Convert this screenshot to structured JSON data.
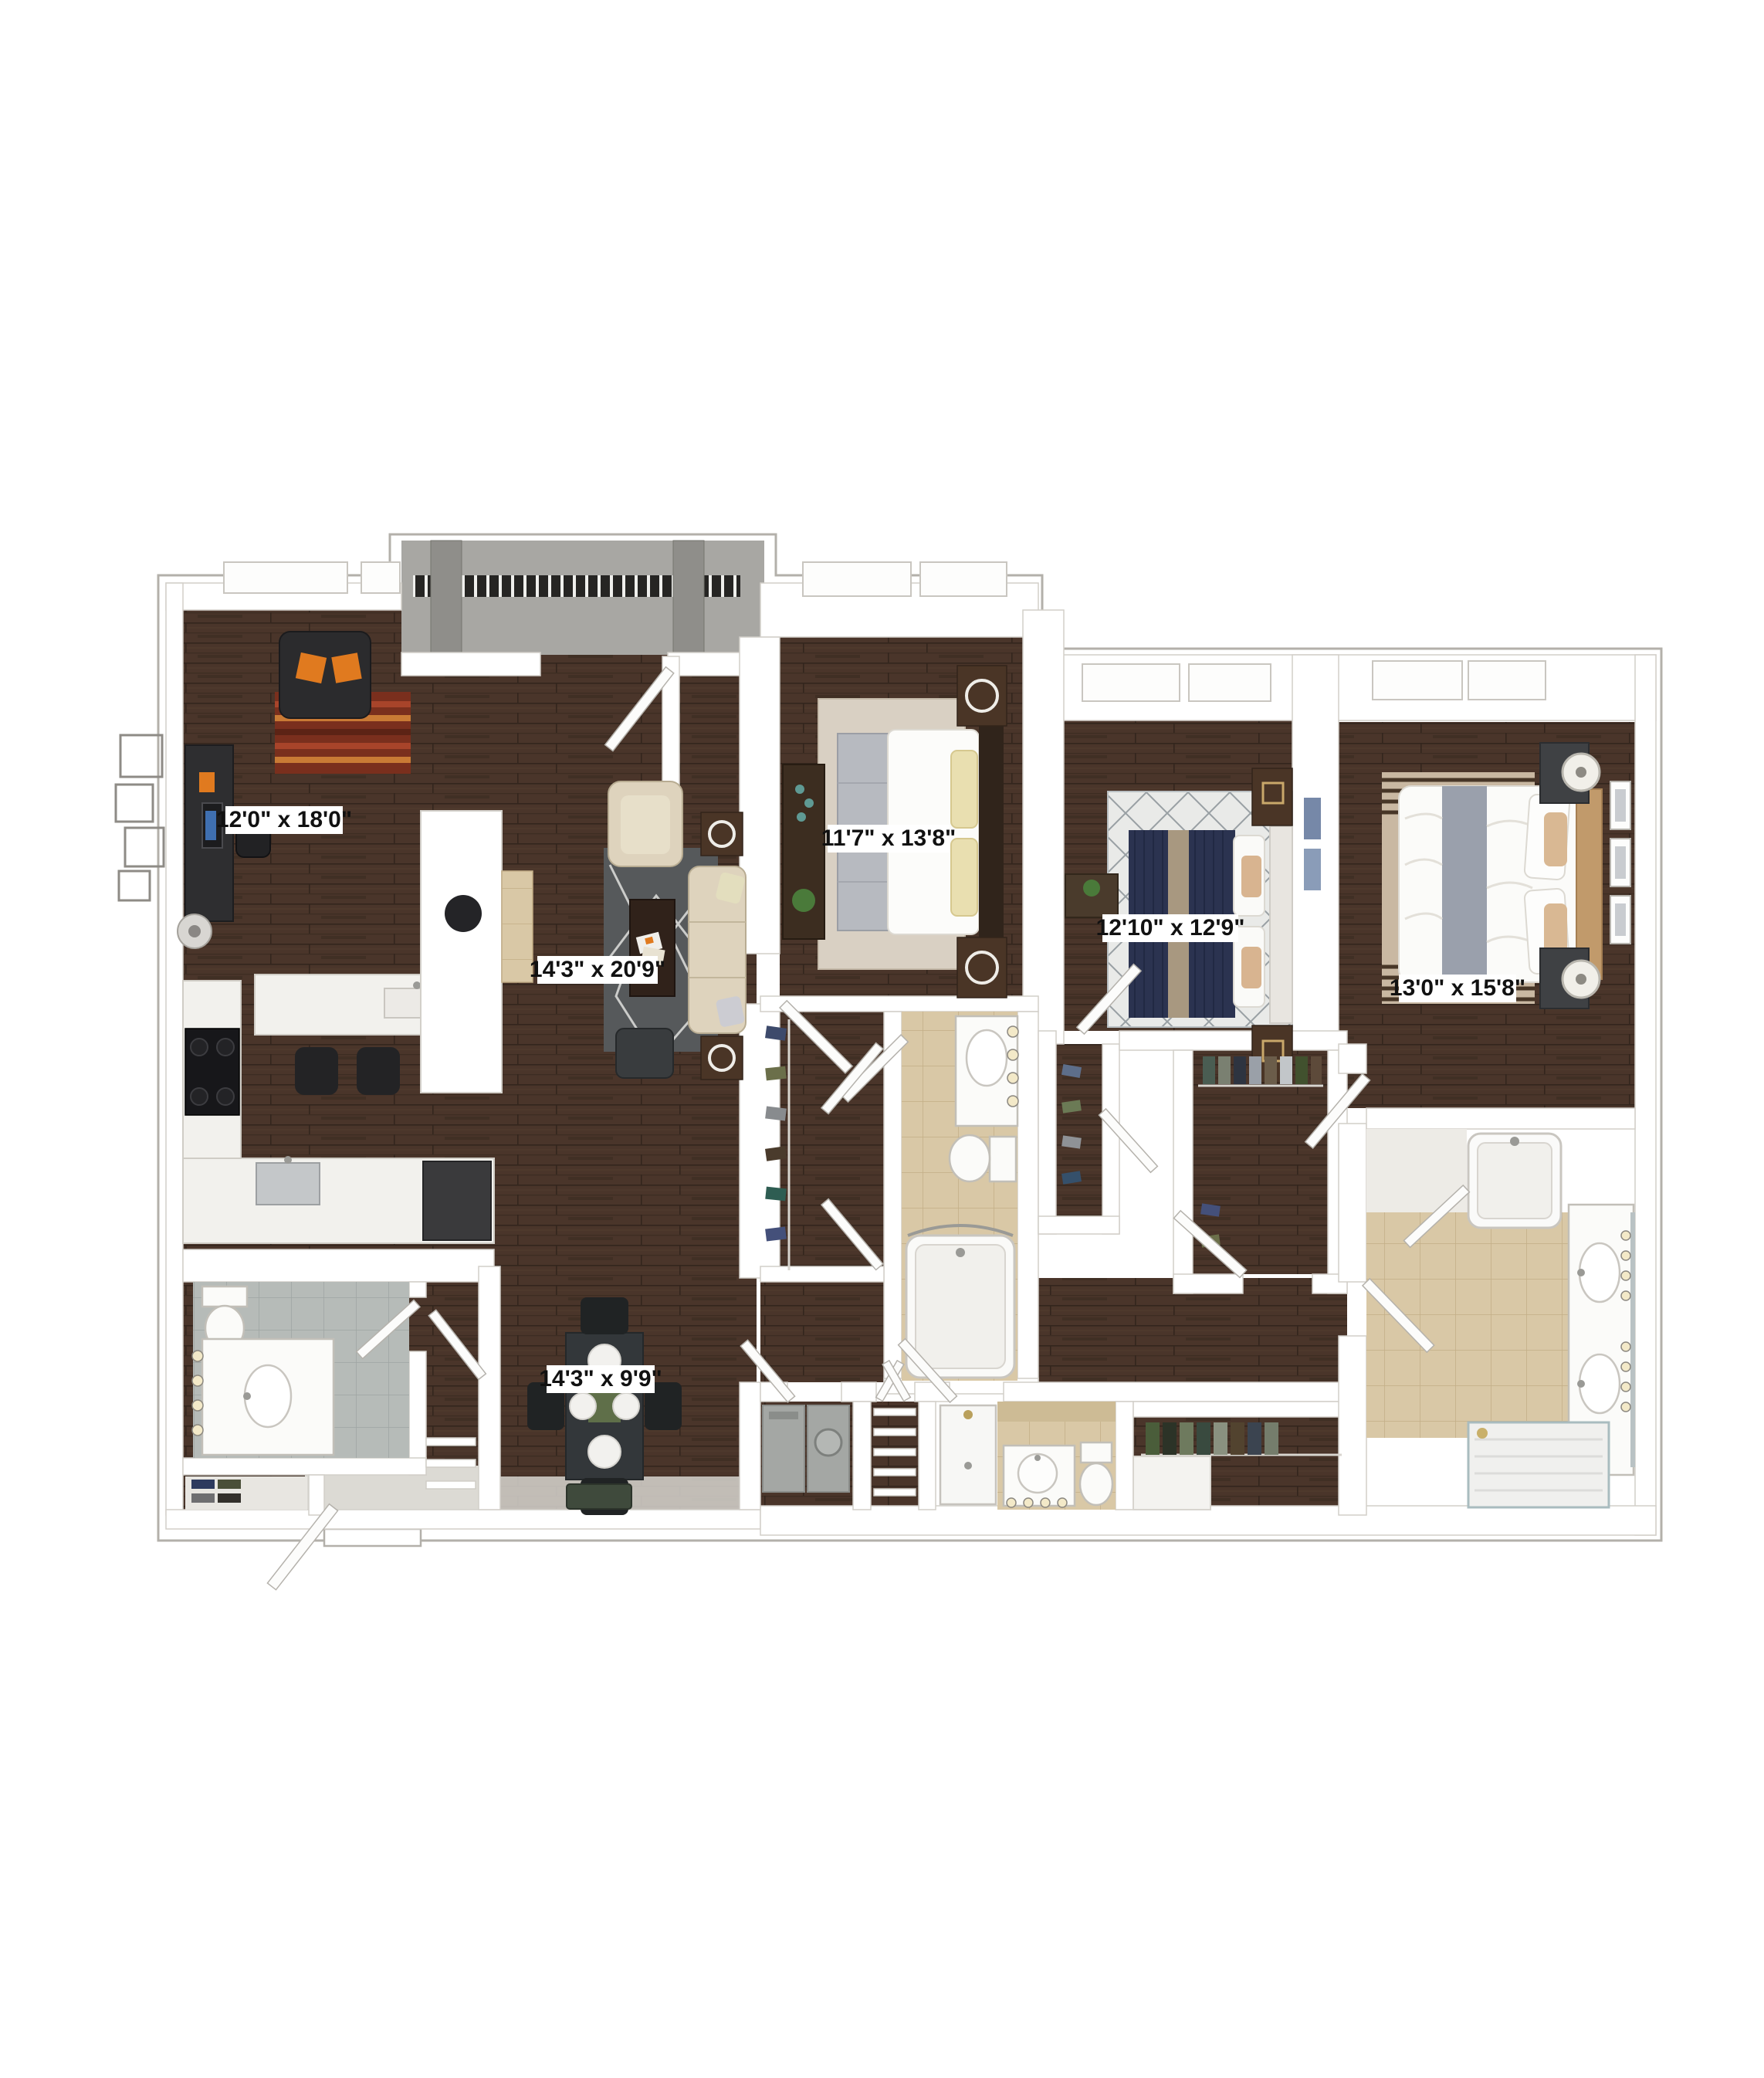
{
  "plan": {
    "kind": "3d-apartment-floor-plan",
    "rooms": [
      {
        "id": "den",
        "label": "12'0\" x 18'0\""
      },
      {
        "id": "bedroom-1",
        "label": "11'7\" x 13'8\""
      },
      {
        "id": "bedroom-2",
        "label": "12'10\" x 12'9\""
      },
      {
        "id": "bedroom-3",
        "label": "13'0\" x 15'8\""
      },
      {
        "id": "living-room",
        "label": "14'3\" x 20'9\""
      },
      {
        "id": "dining-area",
        "label": "14'3\" x 9'9\""
      }
    ]
  },
  "palette": {
    "wood": "#4a352a",
    "wall": "#ffffff",
    "outline": "#b3b0aa",
    "tile_beige": "#d9c8a6",
    "tile_gray": "#b6bbb8",
    "concrete": "#a8a7a3",
    "rug_living": "#56595b",
    "sofa_cream": "#ded3bd",
    "rug_red": "#7a2f1d",
    "accent_orange": "#e07a1f",
    "bed_navy": "#2b3350",
    "rug_bed1": "#d9d0c3",
    "rug_bed2": "#e9eae8",
    "rug_bed3": "#c9b8a2",
    "label_text": "#111111"
  }
}
